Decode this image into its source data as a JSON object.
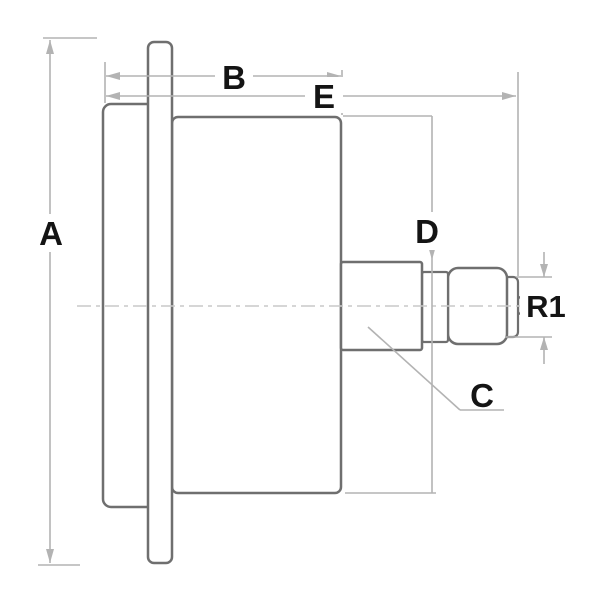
{
  "diagram": {
    "type": "technical-dimension-drawing",
    "subject": "pressure gauge side view with back connection",
    "labels": {
      "a": "A",
      "b": "B",
      "c": "C",
      "d": "D",
      "e": "E",
      "r1": "R1"
    },
    "colors": {
      "outline": "#6f6f6f",
      "dimension": "#b3b3b3",
      "centerline": "#c9c9c9",
      "label_text": "#141414",
      "background": "#ffffff"
    }
  }
}
